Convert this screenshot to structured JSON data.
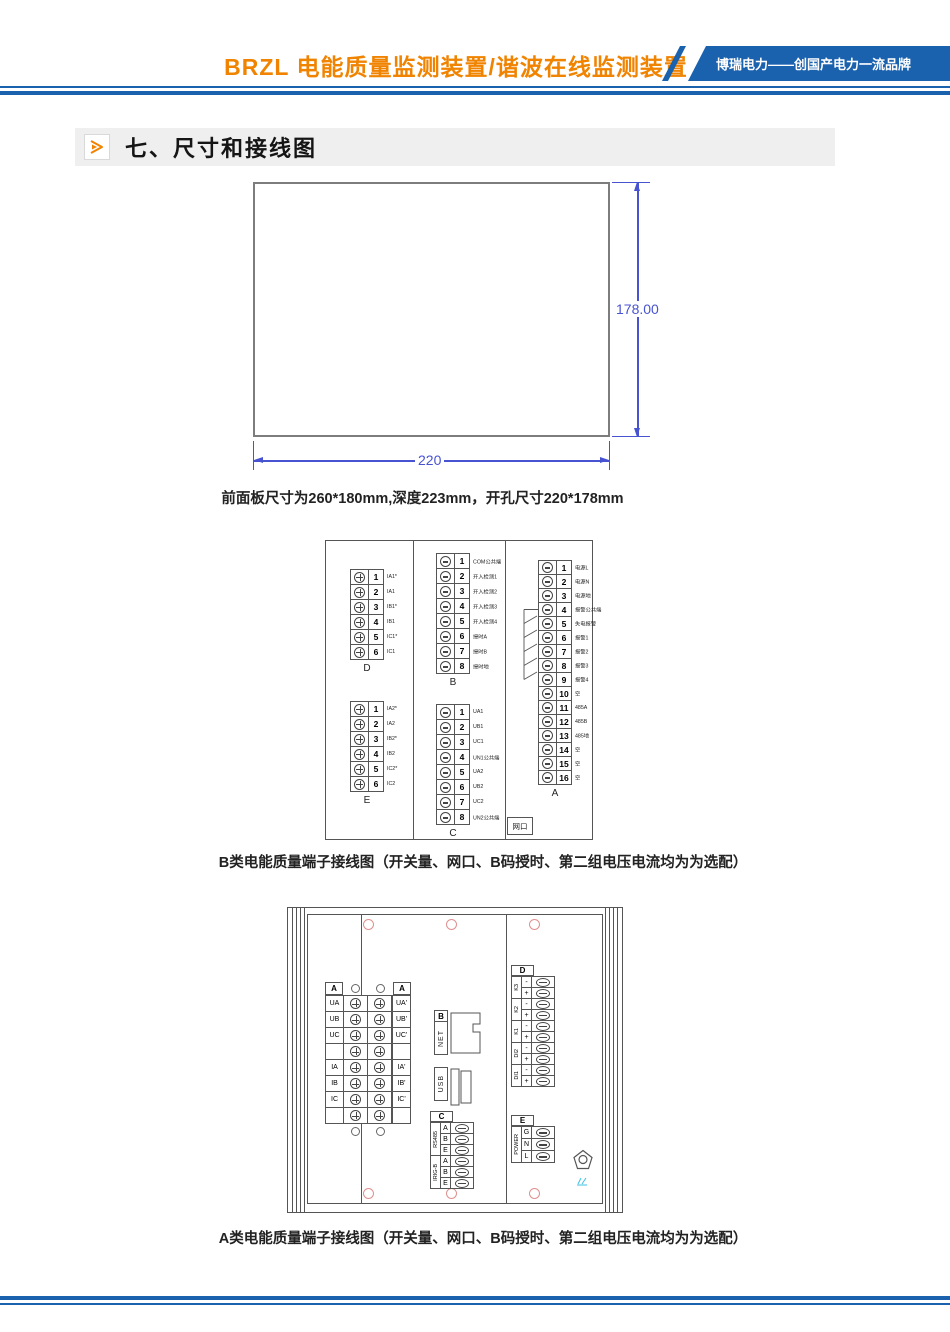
{
  "header": {
    "title": "BRZL 电能质量监测装置/谐波在线监测装置",
    "brand": "博瑞电力——创国产电力一流品牌"
  },
  "section": {
    "title": "七、尺寸和接线图"
  },
  "colors": {
    "accent_orange": "#f08300",
    "banner_blue": "#1a61ae",
    "dimension_blue": "#4753d0",
    "hole_pink": "#e09090",
    "stamp_cyan": "#3ec1e0"
  },
  "dimension_figure": {
    "height_label": "178.00",
    "width_label": "220",
    "caption": "前面板尺寸为260*180mm,深度223mm，开孔尺寸220*178mm"
  },
  "diagram_b": {
    "caption": "B类电能质量端子接线图（开关量、网口、B码授时、第二组电压电流均为为选配）",
    "net_box": "网口",
    "block_d": {
      "name": "D",
      "rows": [
        {
          "n": "1",
          "t": "IA1*"
        },
        {
          "n": "2",
          "t": "IA1"
        },
        {
          "n": "3",
          "t": "IB1*"
        },
        {
          "n": "4",
          "t": "IB1"
        },
        {
          "n": "5",
          "t": "IC1*"
        },
        {
          "n": "6",
          "t": "IC1"
        }
      ]
    },
    "block_e": {
      "name": "E",
      "rows": [
        {
          "n": "1",
          "t": "IA2*"
        },
        {
          "n": "2",
          "t": "IA2"
        },
        {
          "n": "3",
          "t": "IB2*"
        },
        {
          "n": "4",
          "t": "IB2"
        },
        {
          "n": "5",
          "t": "IC2*"
        },
        {
          "n": "6",
          "t": "IC2"
        }
      ]
    },
    "block_b": {
      "name": "B",
      "rows": [
        {
          "n": "1",
          "t": "COM公共端"
        },
        {
          "n": "2",
          "t": "开入检测1"
        },
        {
          "n": "3",
          "t": "开入检测2"
        },
        {
          "n": "4",
          "t": "开入检测3"
        },
        {
          "n": "5",
          "t": "开入检测4"
        },
        {
          "n": "6",
          "t": "授时A"
        },
        {
          "n": "7",
          "t": "授时B"
        },
        {
          "n": "8",
          "t": "授时地"
        }
      ]
    },
    "block_c": {
      "name": "C",
      "rows": [
        {
          "n": "1",
          "t": "UA1"
        },
        {
          "n": "2",
          "t": "UB1"
        },
        {
          "n": "3",
          "t": "UC1"
        },
        {
          "n": "4",
          "t": "UN1公共端"
        },
        {
          "n": "5",
          "t": "UA2"
        },
        {
          "n": "6",
          "t": "UB2"
        },
        {
          "n": "7",
          "t": "UC2"
        },
        {
          "n": "8",
          "t": "UN2公共端"
        }
      ]
    },
    "block_a": {
      "name": "A",
      "rows": [
        {
          "n": "1",
          "t": "电源L"
        },
        {
          "n": "2",
          "t": "电源N"
        },
        {
          "n": "3",
          "t": "电源地"
        },
        {
          "n": "4",
          "t": "报警公共端"
        },
        {
          "n": "5",
          "t": "失电报警"
        },
        {
          "n": "6",
          "t": "报警1"
        },
        {
          "n": "7",
          "t": "报警2"
        },
        {
          "n": "8",
          "t": "报警3"
        },
        {
          "n": "9",
          "t": "报警4"
        },
        {
          "n": "10",
          "t": "空"
        },
        {
          "n": "11",
          "t": "485A"
        },
        {
          "n": "12",
          "t": "485B"
        },
        {
          "n": "13",
          "t": "485地"
        },
        {
          "n": "14",
          "t": "空"
        },
        {
          "n": "15",
          "t": "空"
        },
        {
          "n": "16",
          "t": "空"
        }
      ]
    }
  },
  "diagram_a": {
    "caption": "A类电能质量端子接线图（开关量、网口、B码授时、第二组电压电流均为为选配）",
    "analog_block": {
      "header_left": "A",
      "header_right": "A",
      "rows": [
        {
          "l": "UA",
          "r": "UA'"
        },
        {
          "l": "UB",
          "r": "UB'"
        },
        {
          "l": "UC",
          "r": "UC'"
        },
        {
          "l": "",
          "r": ""
        },
        {
          "l": "IA",
          "r": "IA'"
        },
        {
          "l": "IB",
          "r": "IB'"
        },
        {
          "l": "IC",
          "r": "IC'"
        },
        {
          "l": "",
          "r": ""
        }
      ]
    },
    "net": {
      "header": "B",
      "label": "NET"
    },
    "usb": {
      "label": "USB"
    },
    "comm_block": {
      "header": "C",
      "groups": [
        {
          "g": "RS485",
          "a": "A",
          "b": "B",
          "c": "E"
        },
        {
          "g": "IRIG-B",
          "a": "A",
          "b": "B",
          "c": "E"
        }
      ]
    },
    "io_block": {
      "header": "D",
      "groups": [
        {
          "g": "K3",
          "r1": "-",
          "r2": "+"
        },
        {
          "g": "K2",
          "r1": "-",
          "r2": "+"
        },
        {
          "g": "K1",
          "r1": "-",
          "r2": "+"
        },
        {
          "g": "DI2",
          "r1": "-",
          "r2": "+"
        },
        {
          "g": "DI1",
          "r1": "-",
          "r2": "+"
        }
      ]
    },
    "power_block": {
      "header": "E",
      "group": "POWER",
      "rows": [
        "G",
        "N",
        "L"
      ]
    }
  }
}
